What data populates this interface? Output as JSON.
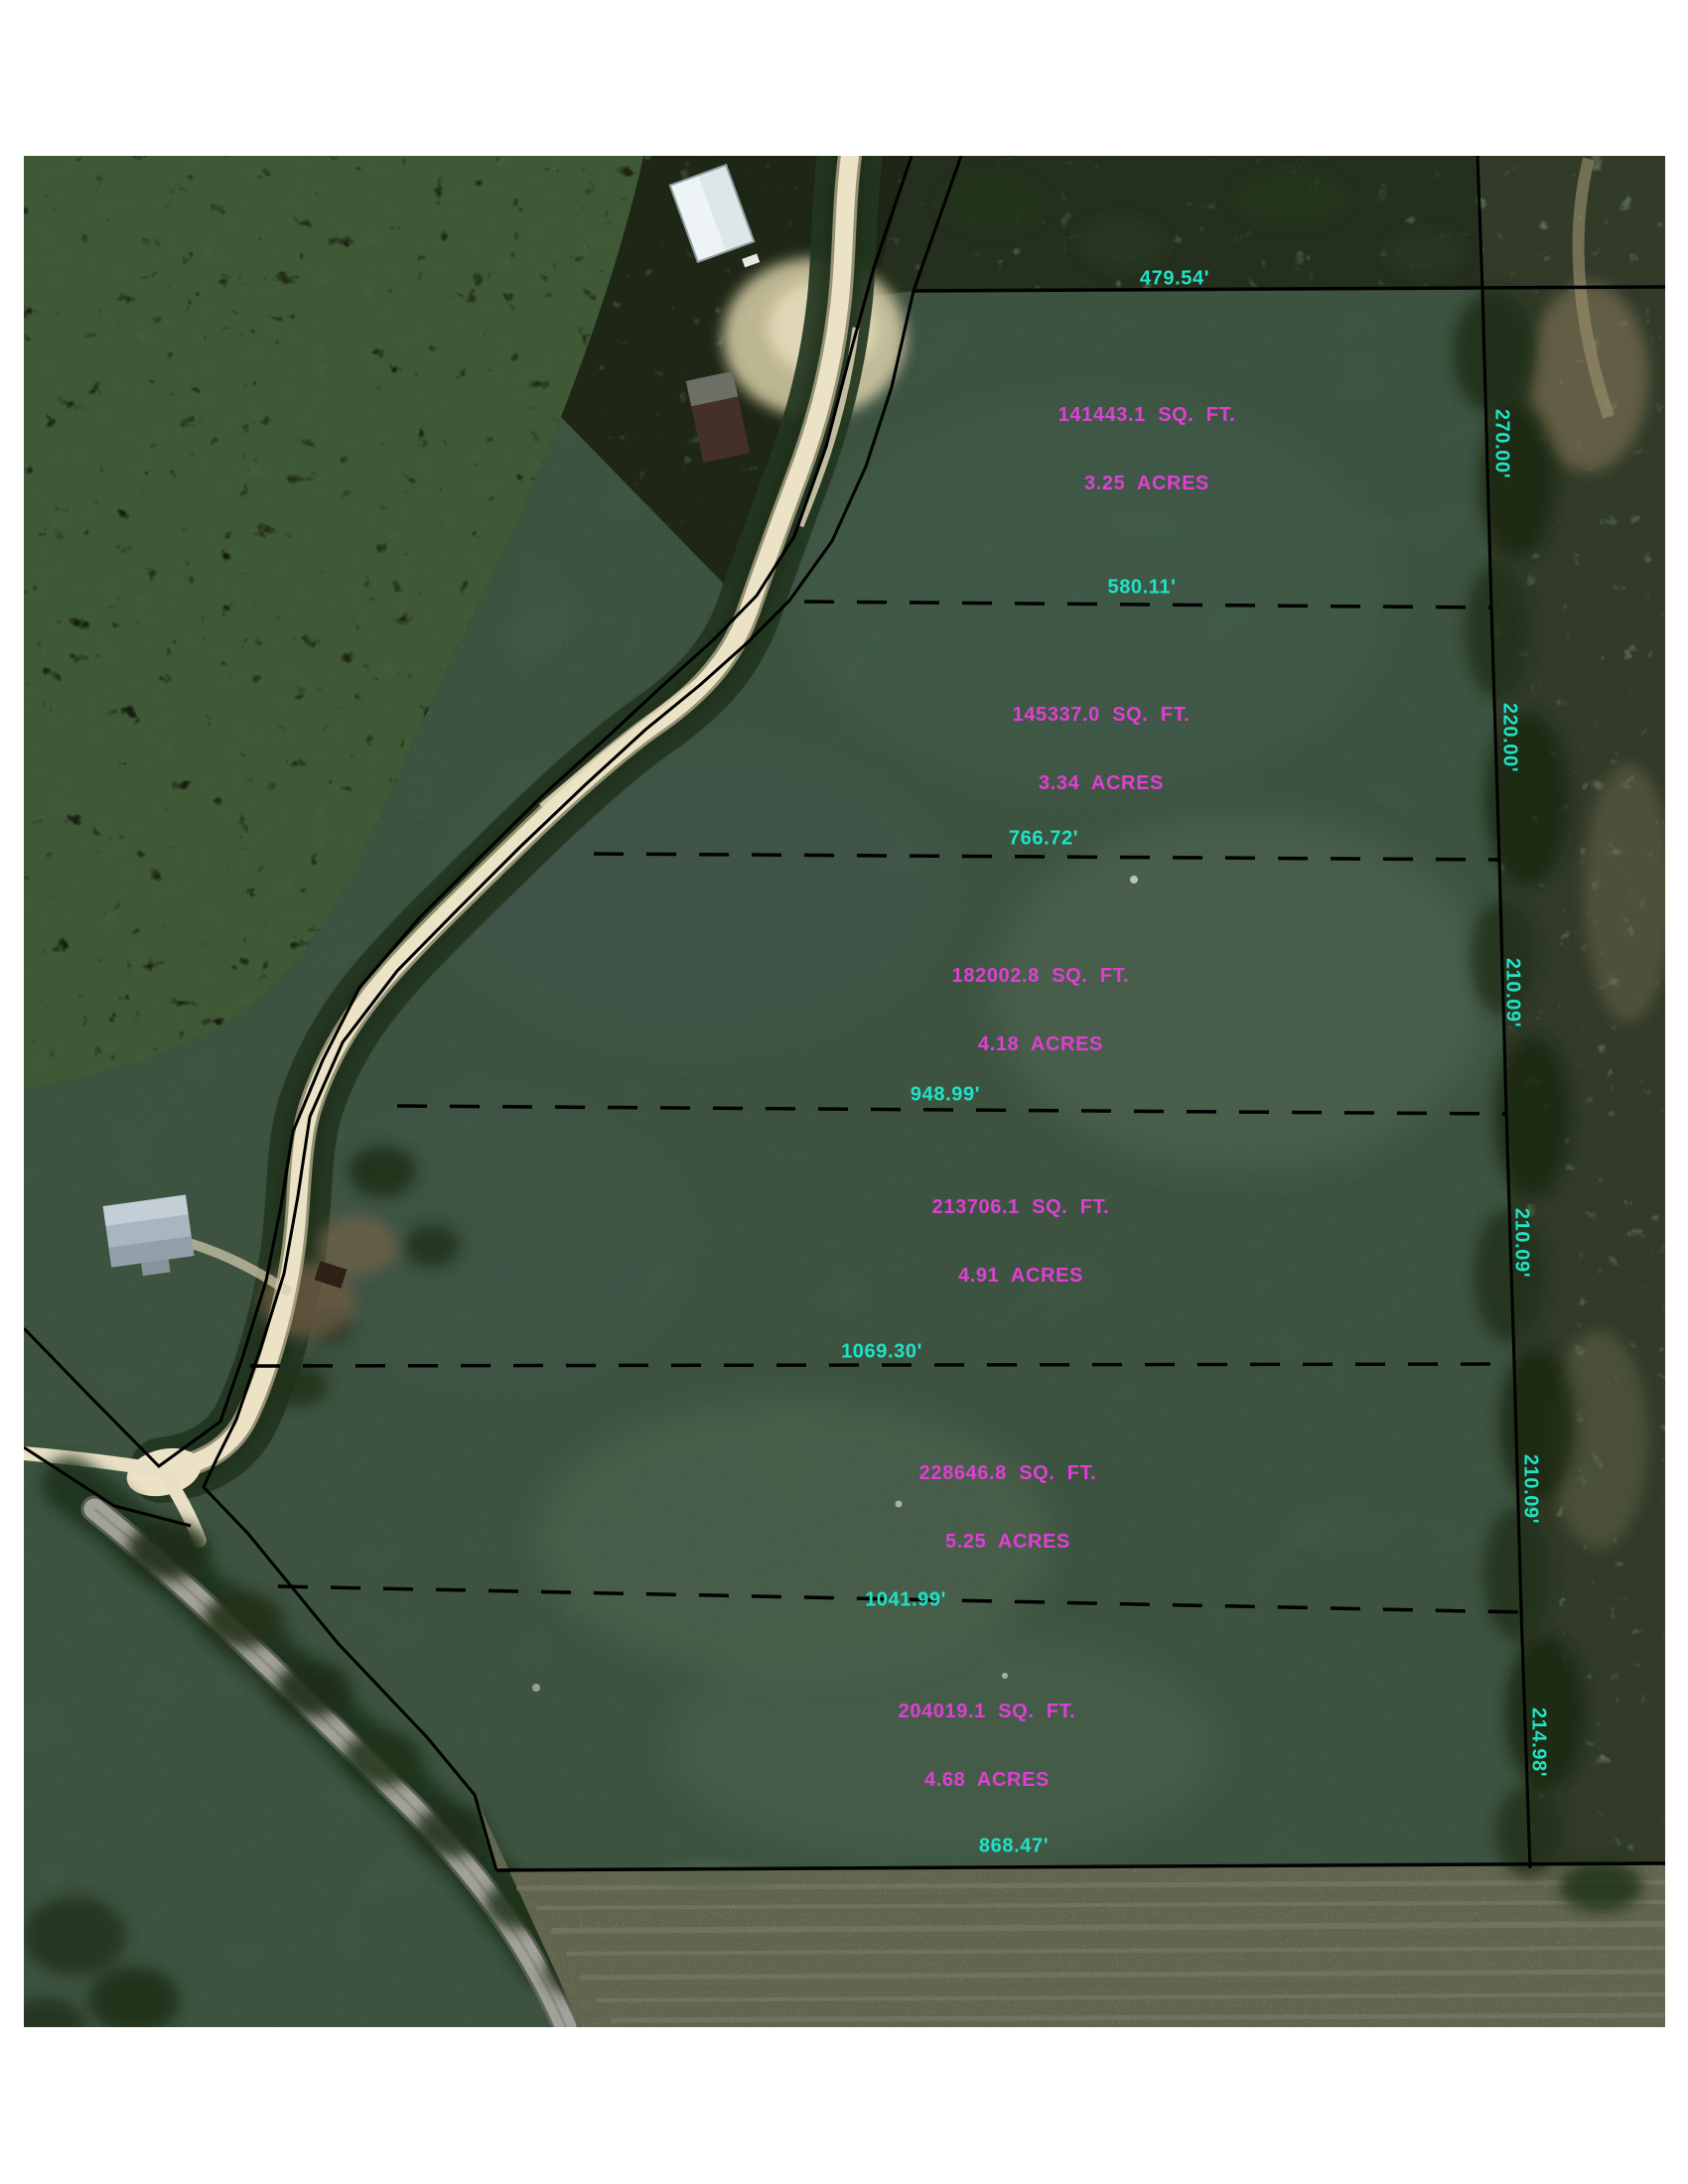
{
  "theme": {
    "page_background": "#ffffff",
    "dimension_text_color": "#1fe3c6",
    "area_text_color": "#df3fd4",
    "boundary_line_color": "#000000",
    "field_green": "#4c6350",
    "forest_green": "#2b3d26",
    "dirt_road": "#ece3c7",
    "paved_road": "#a2a29a",
    "plowed_field_brown": "#79765f"
  },
  "map": {
    "type": "aerial-plat-survey",
    "north_boundary": {
      "length": "479.54'"
    },
    "south_boundary": {
      "length": "868.47'"
    },
    "east_segments": [
      "270.00'",
      "220.00'",
      "210.09'",
      "210.09'",
      "210.09'",
      "214.98'"
    ],
    "division_lines": [
      "580.11'",
      "766.72'",
      "948.99'",
      "1069.30'",
      "1041.99'"
    ],
    "parcels": [
      {
        "sqft": "141443.1  SQ.  FT.",
        "acres": "3.25  ACRES"
      },
      {
        "sqft": "145337.0  SQ.  FT.",
        "acres": "3.34  ACRES"
      },
      {
        "sqft": "182002.8  SQ.  FT.",
        "acres": "4.18  ACRES"
      },
      {
        "sqft": "213706.1  SQ.  FT.",
        "acres": "4.91  ACRES"
      },
      {
        "sqft": "228646.8  SQ.  FT.",
        "acres": "5.25  ACRES"
      },
      {
        "sqft": "204019.1  SQ.  FT.",
        "acres": "4.68  ACRES"
      }
    ]
  }
}
